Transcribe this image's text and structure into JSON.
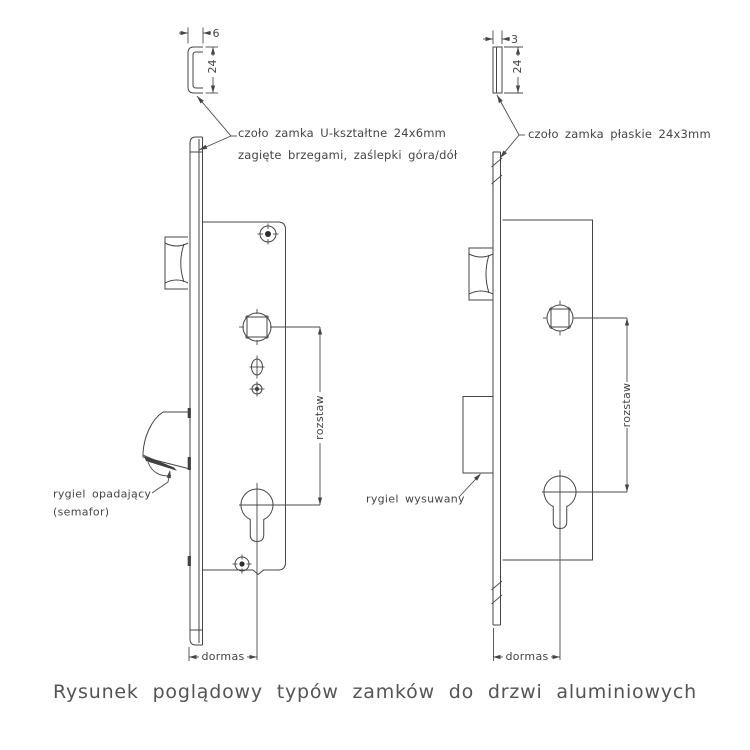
{
  "caption": "Rysunek poglądowy typów zamków do drzwi aluminiowych",
  "colors": {
    "line": "#454545",
    "text": "#454545",
    "caption_text": "#545454",
    "background": "#ffffff"
  },
  "left_lock": {
    "profile_depth_dim": "6",
    "profile_height_dim": "24",
    "faceplate_note_line1": "czoło zamka U-kształtne 24x6mm",
    "faceplate_note_line2": "zagięte brzegami, zaślepki góra/dół",
    "bolt_note_line1": "rygiel opadający",
    "bolt_note_line2": "(semafor)",
    "spacing_dim_label": "rozstaw",
    "backset_dim_label": "dormas"
  },
  "right_lock": {
    "profile_depth_dim": "3",
    "profile_height_dim": "24",
    "faceplate_note": "czoło zamka płaskie 24x3mm",
    "bolt_note": "rygiel wysuwany",
    "spacing_dim_label": "rozstaw",
    "backset_dim_label": "dormas"
  }
}
